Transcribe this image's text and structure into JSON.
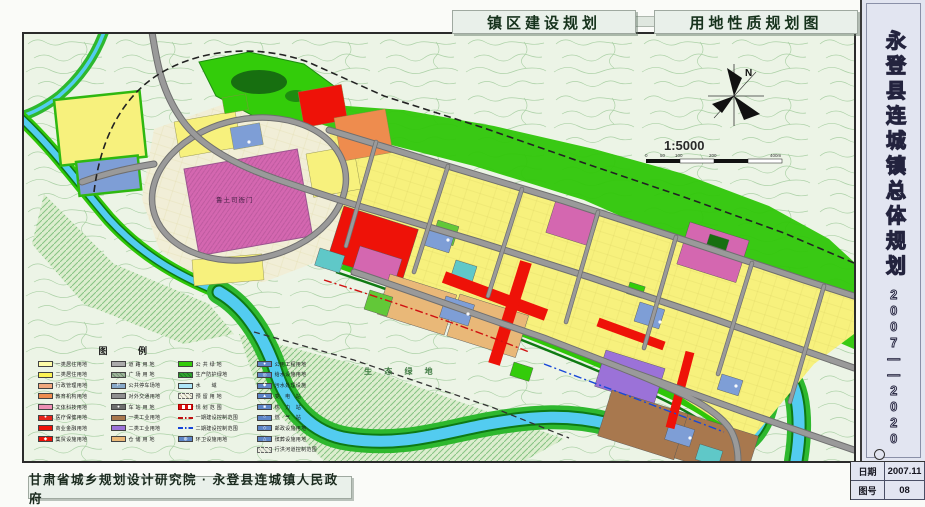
{
  "doc": {
    "title_left": "镇区建设规划",
    "title_right": "用地性质规划图"
  },
  "sidebar": {
    "title": "永登县连城镇总体规划",
    "period": "2007——2020"
  },
  "stamp": {
    "date_label": "日期",
    "date_value": "2007.11",
    "no_label": "图号",
    "no_value": "08"
  },
  "footer": {
    "org": "甘肃省城乡规划设计研究院 · 永登县连城镇人民政府"
  },
  "map": {
    "north_label": "N",
    "scale_text": "1:5000",
    "scale_ticks": [
      "0",
      "50",
      "100",
      "200",
      "400m"
    ],
    "labels": {
      "eco_green": "生 态 绿 地",
      "heritage": "鲁土司衙门"
    }
  },
  "legend": {
    "title": "图  例",
    "columns": [
      {
        "items": [
          {
            "label": "一类居住用地",
            "swatch": "fill",
            "color": "#FFFDA8"
          },
          {
            "label": "二类居住用地",
            "swatch": "fill",
            "color": "#FCF354"
          },
          {
            "label": "行政管理用地",
            "swatch": "fill",
            "color": "#F2A97E"
          },
          {
            "label": "教育机构用地",
            "swatch": "fill",
            "color": "#EE8C4E"
          },
          {
            "label": "文体科技用地",
            "swatch": "fill",
            "color": "#EE8FB4"
          },
          {
            "label": "医疗保健用地",
            "swatch": "fill-icon",
            "color": "#E4251B",
            "icon": "●"
          },
          {
            "label": "商业金融用地",
            "swatch": "fill",
            "color": "#EE1208"
          },
          {
            "label": "集贸设施用地",
            "swatch": "fill-icon",
            "color": "#EE1208",
            "icon": "◆"
          }
        ]
      },
      {
        "items": [
          {
            "label": "道 路 用 地",
            "swatch": "fill",
            "color": "#ABABAB"
          },
          {
            "label": "广 场 用 地",
            "swatch": "fill-pattern",
            "color": "#9FB49B",
            "color2": "#6E8F6E"
          },
          {
            "label": "公共停车场地",
            "swatch": "fill-icon",
            "color": "#86A8C8",
            "icon": "P"
          },
          {
            "label": "对外交通用地",
            "swatch": "fill",
            "color": "#8F8F8F"
          },
          {
            "label": "车 站 用 地",
            "swatch": "fill-icon",
            "color": "#6E6E6E",
            "icon": "●"
          },
          {
            "label": "一类工业用地",
            "swatch": "fill",
            "color": "#A8784E"
          },
          {
            "label": "二类工业用地",
            "swatch": "fill",
            "color": "#9B72D8"
          },
          {
            "label": "仓 储 用 地",
            "swatch": "fill",
            "color": "#E9B878"
          }
        ]
      },
      {
        "items": [
          {
            "label": "公 共 绿 地",
            "swatch": "fill",
            "color": "#33CC0A"
          },
          {
            "label": "生产防护绿地",
            "swatch": "fill-pattern",
            "color": "#2FA32F",
            "color2": "#1E7A1E"
          },
          {
            "label": "水　　域",
            "swatch": "fill",
            "color": "#AEE6F8"
          },
          {
            "label": "预 留 用 地",
            "swatch": "hatch-dash",
            "color": "#F4F4E6",
            "color2": "#B9B9A0"
          },
          {
            "label": "规 划 范 围",
            "swatch": "dash-thick",
            "color": "#E01010"
          },
          {
            "label": "一期建设控制范围",
            "swatch": "dash-dot",
            "color": "#C01010"
          },
          {
            "label": "二期建设控制范围",
            "swatch": "dash-dot",
            "color": "#1545D8"
          },
          {
            "label": "环卫设施用地",
            "swatch": "fill-icon",
            "color": "#5E86C8",
            "icon": "◍"
          }
        ]
      },
      {
        "items": [
          {
            "label": "公用工程用地",
            "swatch": "fill-icon",
            "color": "#5E86C8",
            "icon": "●"
          },
          {
            "label": "给水设施用地",
            "swatch": "fill-icon",
            "color": "#5E86C8",
            "icon": "◎"
          },
          {
            "label": "污水处理设施",
            "swatch": "fill-icon",
            "color": "#5E86C8",
            "icon": "◆"
          },
          {
            "label": "变　电　站",
            "swatch": "fill-icon",
            "color": "#5E86C8",
            "icon": "▲"
          },
          {
            "label": "热　力　站",
            "swatch": "fill-icon",
            "color": "#5E86C8",
            "icon": "■"
          },
          {
            "label": "燃　气　站",
            "swatch": "fill-icon",
            "color": "#5E86C8",
            "icon": "○"
          },
          {
            "label": "邮政设施用地",
            "swatch": "fill-icon",
            "color": "#5E86C8",
            "icon": "◇"
          },
          {
            "label": "殡葬设施用地",
            "swatch": "fill-icon",
            "color": "#5E86C8",
            "icon": "△"
          },
          {
            "label": "行洪河道控制范围",
            "swatch": "hatch-dash",
            "color": "#EDEDE0",
            "color2": "#A8B4A8"
          }
        ]
      }
    ]
  },
  "palette": {
    "bg": "#ECF4E6",
    "topo_line": "#A5CDA0",
    "residential": "#F7F17D",
    "commercial": "#EE1208",
    "admin": "#F2A97E",
    "education": "#EE8C4E",
    "culture": "#D467B0",
    "industry1": "#A8784E",
    "industry2": "#9B72D8",
    "storage": "#E9B878",
    "utility": "#7E9ED6",
    "park_green": "#33CC0A",
    "protect_green": "#2FC608",
    "water": "#53CCF0",
    "road": "#9A9A9A",
    "eco_hatch": "#6FB96F"
  }
}
